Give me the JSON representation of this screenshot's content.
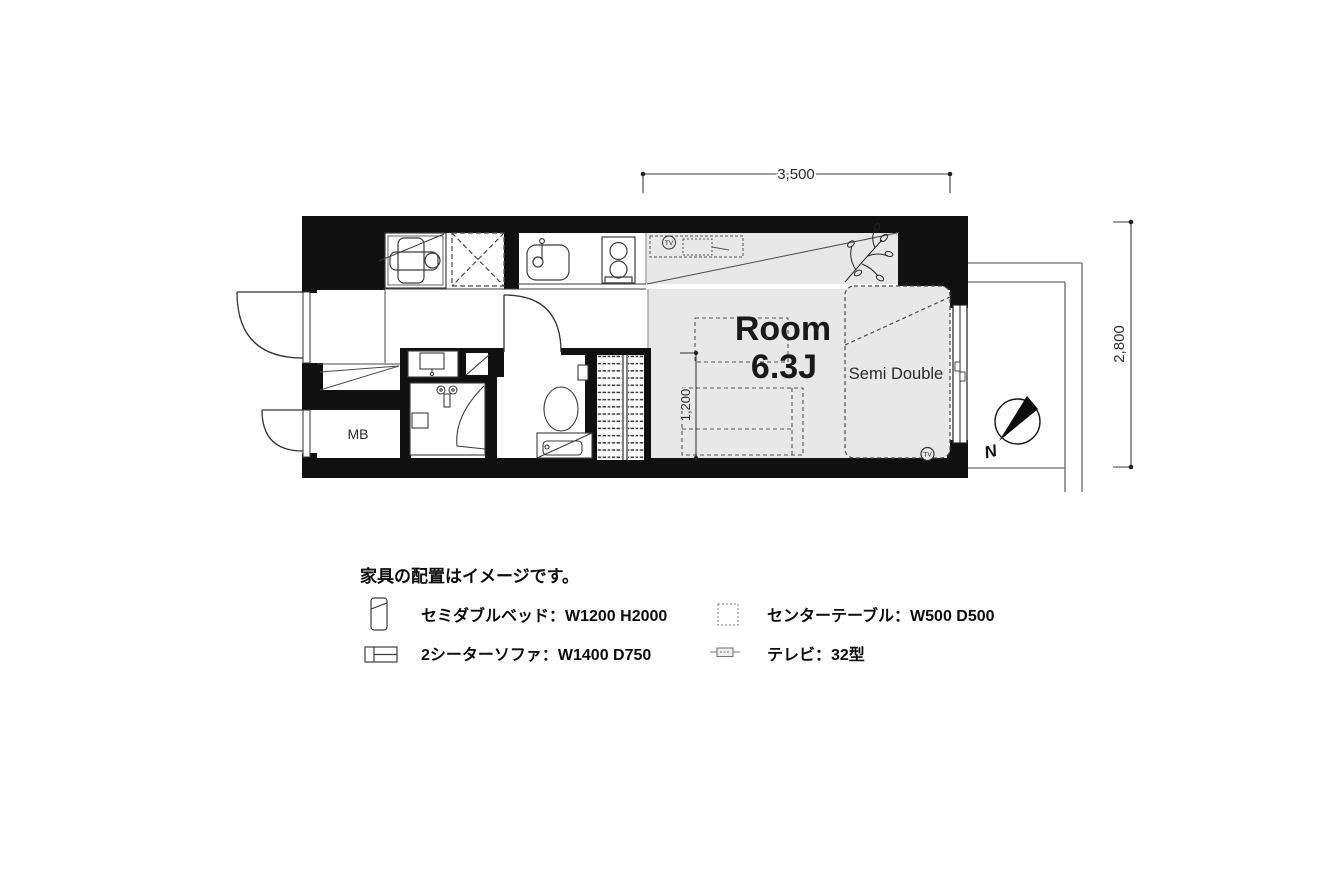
{
  "floorplan": {
    "room_label": "Room",
    "room_size": "6.3J",
    "bed_label": "Semi Double",
    "meter_box_label": "MB",
    "tv_badge": "TV",
    "compass_label": "N",
    "dimensions": {
      "top": "3,500",
      "right": "2,800",
      "inner": "1,200"
    }
  },
  "legend": {
    "note": "家具の配置はイメージです。",
    "items": [
      {
        "icon": "bed-icon",
        "label": "セミダブルベッド：W1200 H2000"
      },
      {
        "icon": "table-icon",
        "label": "センターテーブル：W500 D500"
      },
      {
        "icon": "sofa-icon",
        "label": "2シーターソファ：W1400 D750"
      },
      {
        "icon": "tv-icon",
        "label": "テレビ：32型"
      }
    ]
  },
  "colors": {
    "wall": "#101010",
    "floor_gray": "#e8e8e8",
    "line": "#3c3c3c"
  }
}
